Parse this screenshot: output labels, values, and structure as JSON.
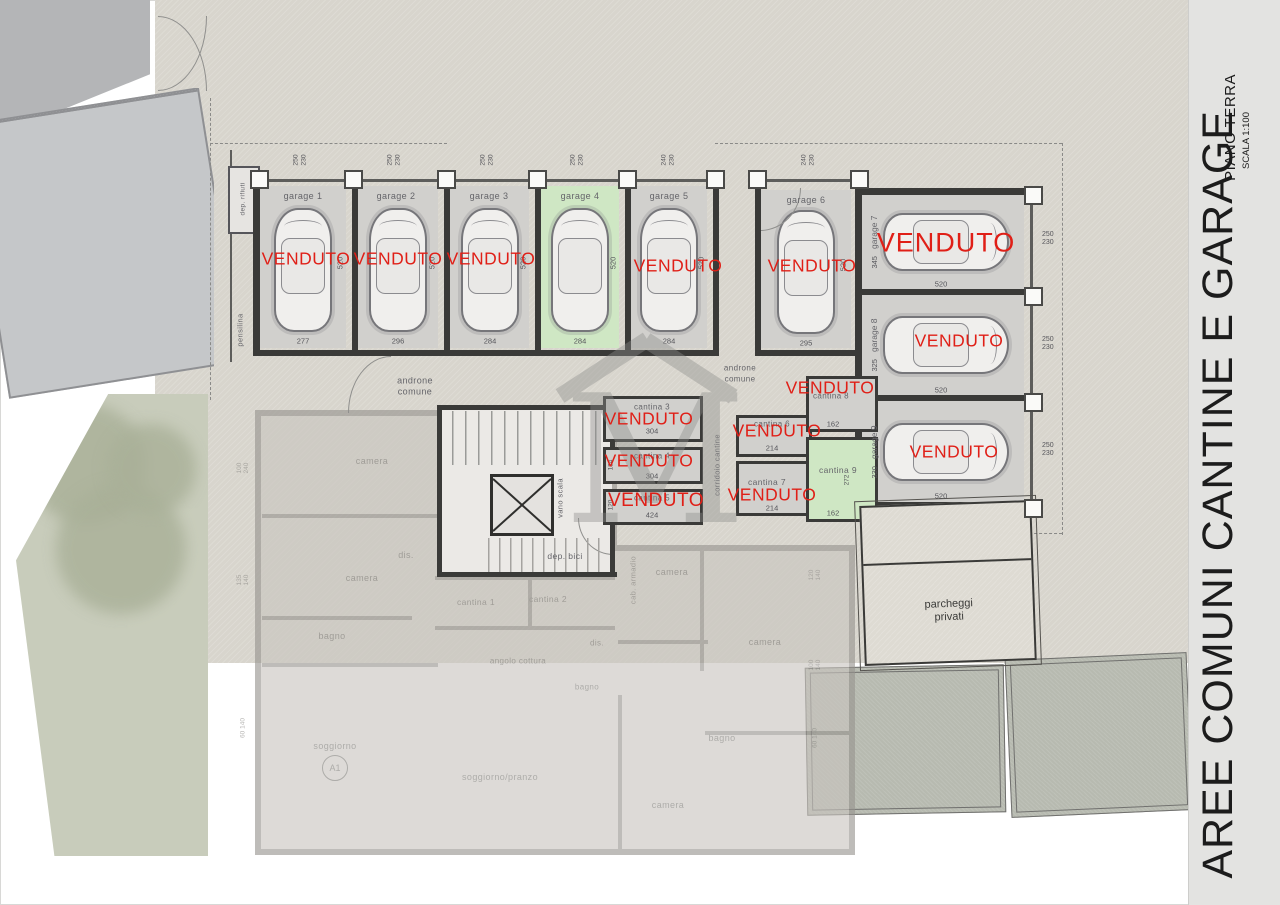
{
  "title_block": {
    "title": "AREE COMUNI CANTINE E GARAGE",
    "floor": "PIANO TERRA",
    "scale": "SCALA 1:100"
  },
  "sold_text": "VENDUTO",
  "garages_top": [
    {
      "name": "garage 1",
      "floor_dim": "277",
      "door_dim": "250 230",
      "depth_dim": "520",
      "sold": true
    },
    {
      "name": "garage 2",
      "floor_dim": "296",
      "door_dim": "250 230",
      "depth_dim": "520",
      "sold": true
    },
    {
      "name": "garage 3",
      "floor_dim": "284",
      "door_dim": "250 230",
      "depth_dim": "520",
      "sold": true
    },
    {
      "name": "garage 4",
      "floor_dim": "284",
      "door_dim": "250 230",
      "depth_dim": "520",
      "sold": false
    },
    {
      "name": "garage 5",
      "floor_dim": "284",
      "door_dim": "240 230",
      "depth_dim": "520",
      "sold": true
    },
    {
      "name": "garage 6",
      "floor_dim": "295",
      "door_dim": "240 230",
      "depth_dim": "520",
      "sold": true
    }
  ],
  "garages_side": [
    {
      "name": "garage 7",
      "length_dim": "345",
      "floor_dim": "520",
      "door_dim": "250 230",
      "sold": true
    },
    {
      "name": "garage 8",
      "length_dim": "325",
      "floor_dim": "520",
      "door_dim": "250 230",
      "sold": true
    },
    {
      "name": "garage 9",
      "length_dim": "330",
      "floor_dim": "520",
      "door_dim": "250 230",
      "sold": true
    }
  ],
  "cantine": [
    {
      "name": "cantina 3",
      "floor_dim": "304",
      "sold": true
    },
    {
      "name": "cantina 4",
      "floor_dim": "304",
      "side_dim": "134",
      "sold": true
    },
    {
      "name": "cantina 5",
      "floor_dim": "424",
      "side_dim": "120",
      "sold": true
    },
    {
      "name": "cantina 6",
      "floor_dim": "214",
      "sold": true
    },
    {
      "name": "cantina 7",
      "floor_dim": "214",
      "sold": true
    },
    {
      "name": "cantina 8",
      "floor_dim": "162",
      "sold": true
    },
    {
      "name": "cantina 9",
      "floor_dim": "162",
      "side_dim": "272",
      "sold": false
    }
  ],
  "common": {
    "androne": "androne comune",
    "corridoio": "corridoio cantine",
    "vano_scala": "vano scala",
    "dep_bici": "dep. bici",
    "dep_rifiuti": "dep. rifiuti",
    "pensilina": "pensilina",
    "parcheggi": "parcheggi privati"
  },
  "apartment": {
    "rooms": [
      "camera",
      "camera",
      "dis.",
      "bagno",
      "soggiorno",
      "soggiorno/pranzo",
      "angolo cottura",
      "dis.",
      "bagno",
      "camera",
      "camera",
      "bagno",
      "camera",
      "cab. armadio",
      "cantina 1",
      "cantina 2"
    ],
    "unit": "A1",
    "window_dims": [
      "100 240",
      "135 140",
      "60 140",
      "120 140",
      "100 140",
      "60 140"
    ]
  },
  "colors": {
    "sold_red": "#e01f17",
    "available_green": "#cfe7c4",
    "courtyard_beige": "#d8d5cd"
  }
}
